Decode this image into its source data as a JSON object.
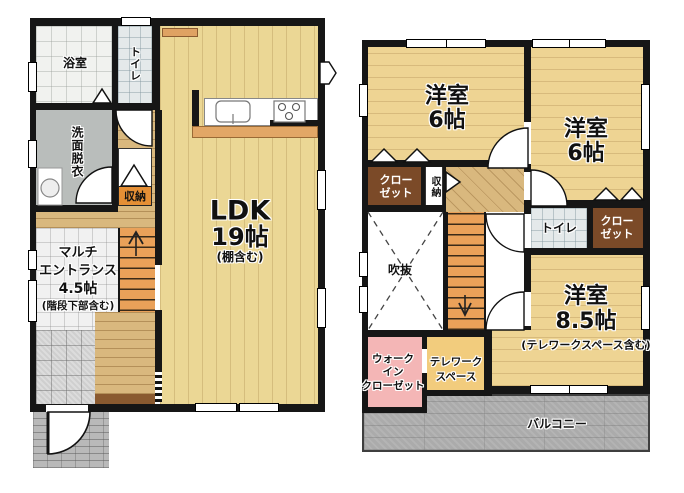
{
  "document_type": "floor-plan",
  "floor1": {
    "bath_label": "浴室",
    "toilet_label": "トイレ",
    "washroom_label": "洗面脱衣",
    "storage_label": "収納",
    "entrance_lines": [
      "マルチ",
      "エントランス",
      "4.5帖",
      "(階段下部含む)"
    ],
    "ldk_lines": [
      "LDK",
      "19帖",
      "(棚含む)"
    ]
  },
  "floor2": {
    "room_nw_lines": [
      "洋室",
      "6帖"
    ],
    "room_ne_lines": [
      "洋室",
      "6帖"
    ],
    "closet_west_lines": [
      "クロー",
      "ゼット"
    ],
    "storage_label": "収納",
    "void_label": "吹抜",
    "toilet_label": "トイレ",
    "closet_east_lines": [
      "クロー",
      "ゼット"
    ],
    "room_south_lines": [
      "洋室",
      "8.5帖",
      "(テレワークスペース含む)"
    ],
    "wic_lines": [
      "ウォーク",
      "イン",
      "クローゼット"
    ],
    "telework_lines": [
      "テレワーク",
      "スペース"
    ],
    "balcony_label": "バルコニー"
  },
  "colors": {
    "wall": "#161616",
    "wood_floor_1f": "#ebd795",
    "wood_floor_2f": "#eed493",
    "hall_wood": "#d9b87e",
    "stairs": "#eaa159",
    "closet": "#7b4a28",
    "storage_label_bg": "#e58f35",
    "washroom": "#b9bdbb",
    "wic": "#f4b6b6",
    "telework": "#f2cc7d",
    "balcony": "#ababab",
    "porch": "#b9b9b9"
  }
}
